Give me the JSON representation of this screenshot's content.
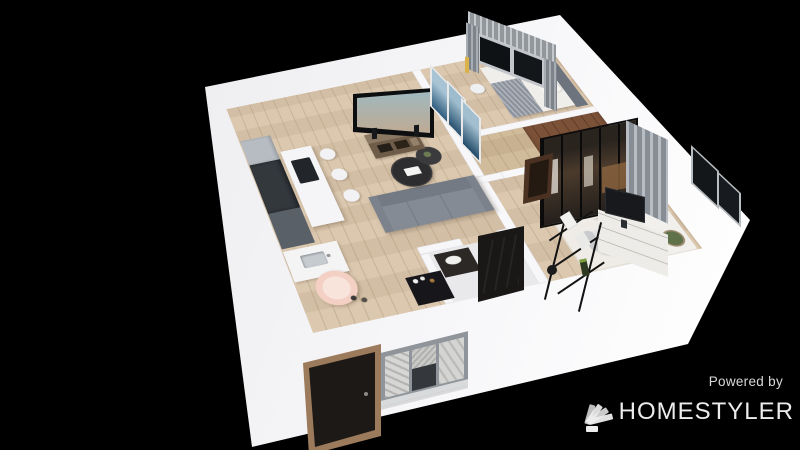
{
  "watermark": {
    "powered_by": "Powered by",
    "brand": "HOMESTYLER"
  },
  "canvas": {
    "width": 800,
    "height": 450,
    "background": "#000000"
  },
  "palette": {
    "wall": "#f4f4f6",
    "floor_wood": "#d9c5ab",
    "sofa": "#848b94",
    "island": "#f5f5f7",
    "kitchen_dark": "#33383d",
    "wardrobe_wood": "#7b5138",
    "door_dark": "#1d1916",
    "entry_frame": "#9c7a5c",
    "window_frame": "#8f959a",
    "window_glass": "#101316",
    "curtain": "#99a0a8",
    "rug": "#efece7",
    "pet_chair": "#f3cfc4",
    "tv_sky": "#2a6075",
    "tv_sunset": "#e09a63"
  },
  "scene": {
    "type": "3d-floorplan-render",
    "rooms": [
      {
        "name": "living-kitchen",
        "furniture": [
          "kitchen-cabinets",
          "fridge",
          "sink-counter",
          "kitchen-island",
          "cooktop",
          "bar-stools",
          "tv",
          "tv-console",
          "sofa",
          "coffee-tables",
          "pet-bed-chair",
          "black-stand",
          "art-frames"
        ]
      },
      {
        "name": "bedroom",
        "furniture": [
          "bed",
          "headboard",
          "pillows",
          "blanket",
          "nightstand",
          "window-with-curtains",
          "wall-lamp"
        ]
      },
      {
        "name": "walk-in-closet",
        "furniture": [
          "glass-front-wardrobe"
        ]
      },
      {
        "name": "office",
        "furniture": [
          "l-desk",
          "monitor",
          "office-chair",
          "white-rug",
          "plant",
          "curtain",
          "corner-window"
        ]
      },
      {
        "name": "bathroom",
        "furniture": [
          "vanity",
          "black-interior-door"
        ]
      },
      {
        "name": "hallway",
        "furniture": [
          "wall-mounted-shelves",
          "wood-interior-door"
        ]
      },
      {
        "name": "entry",
        "furniture": [
          "entry-door",
          "facade-window"
        ]
      }
    ]
  }
}
